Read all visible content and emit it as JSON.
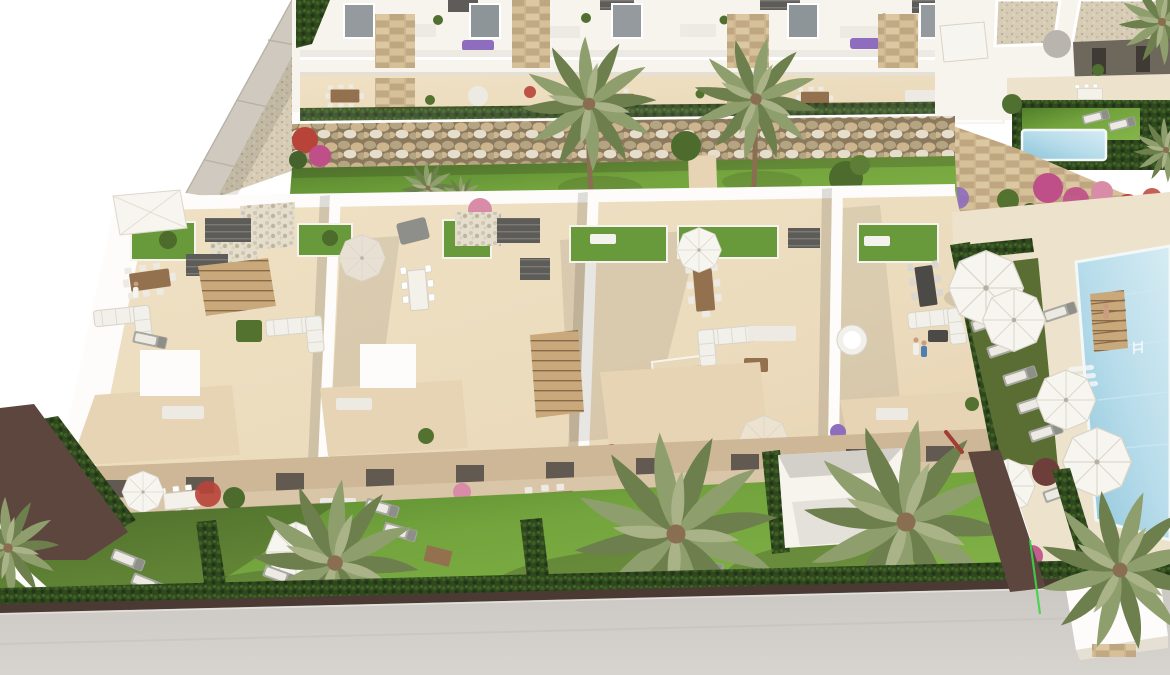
{
  "scene": {
    "type": "3d-architectural-aerial-render",
    "subject": "new-build residential complex: two-storey townhouses with rooftop solariums, private gardens, communal pool, upper apartment row and neighbouring villas",
    "view": "oblique birds-eye from south",
    "visible_text": "",
    "people_count": 4,
    "palm_tree_count": 8,
    "parasol_count": 10,
    "sun_lounger_count": 20,
    "regions": [
      "upper-apartment-terraces",
      "neighbor-villas",
      "private-plunge-pool",
      "gabion-retaining-wall",
      "communal-back-lawn",
      "townhouse-solariums",
      "front-terraces",
      "private-gardens",
      "communal-pool-area",
      "perimeter-road"
    ]
  },
  "palette": {
    "wallWhite": "#f7f4ee",
    "wallBright": "#fdfcfa",
    "wallShade": "#e6dfd3",
    "roofSlab": "#efece5",
    "floorSun": "#f0e1c4",
    "floorWarm": "#e7d4b4",
    "floorShade": "#d9c5a7",
    "terraceShade": "#cdb797",
    "stone": "#cdb590",
    "stoneDark": "#a18a62",
    "gabion": "#b5a482",
    "rockDark": "#8a795c",
    "pebble": "#e5decd",
    "lawn": "#73a43d",
    "lawnLight": "#85b54a",
    "lawnDark": "#507f2a",
    "lawnRoof": "#68993a",
    "hedge": "#30491c",
    "hedgeDark": "#22351a",
    "oliveLawn": "#5a6e33",
    "pool": "#b7dcea",
    "poolDeep": "#8cc4da",
    "poolPale": "#d6ecf3",
    "deck": "#ede2cb",
    "road": "#cbc8c3",
    "roadLight": "#d7d4cf",
    "maroon": "#5c463e",
    "maroonDark": "#4a3a33",
    "wood": "#93714f",
    "plank": "#c9a97c",
    "pergola": "#5d5c58",
    "gravel": "#d7cdb7",
    "umbrella": "#f7f5f0",
    "umbCream": "#ece2cf",
    "furnGrey": "#a8a8a3",
    "furnPale": "#eceae3",
    "flowerMagenta": "#bf4f88",
    "flowerRed": "#b84338",
    "flowerPurple": "#8e6cbe",
    "flowerPink": "#d98ca8",
    "palm": "#8e9e6d",
    "palmDark": "#6d7f4c",
    "palmLight": "#aab387",
    "trunk": "#8a6e52",
    "skin": "#c89e7f",
    "shirtBlue": "#4f7fae",
    "greenLine": "#3ed44a",
    "shadow": "#2f2b22"
  }
}
